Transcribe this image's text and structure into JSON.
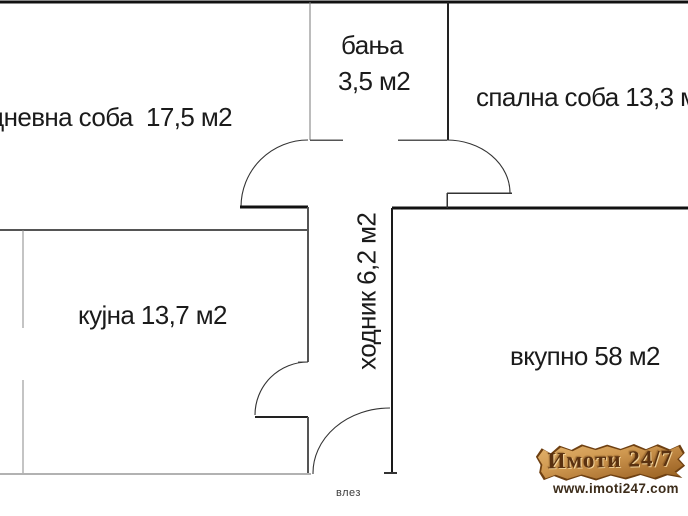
{
  "plan": {
    "labels": {
      "living": "дневна соба  17,5 м2",
      "bathroom_name": "бања",
      "bathroom_area": "3,5 м2",
      "bedroom": "спална соба 13,3 м2",
      "kitchen": "кујна 13,7 м2",
      "hallway": "ходник 6,2 м2",
      "total": "вкупно 58 м2",
      "entrance": "влез"
    },
    "areas_m2": {
      "living": "17,5",
      "bathroom": "3,5",
      "bedroom": "13,3",
      "kitchen": "13,7",
      "hallway": "6,2",
      "total": "58"
    }
  },
  "watermark": {
    "brand": "Имоти 24/7",
    "url": "www.imoti247.com",
    "colors": {
      "banner_light": "#e2b26c",
      "banner_mid": "#cf9850",
      "banner_dark": "#96601f",
      "banner_edge": "#6e4012",
      "brand_text": "#5a3110",
      "url_text": "#3d2d1b"
    }
  },
  "style": {
    "wall_color": "#151515",
    "interior_wall_color": "#555555",
    "text_color": "#1b1b1b",
    "background": "#ffffff"
  }
}
